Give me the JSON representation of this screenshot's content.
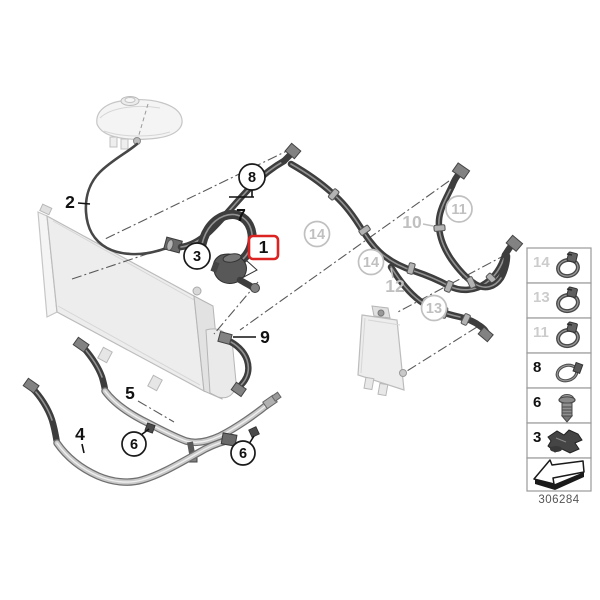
{
  "diagram_type": "cooling-system-hoses-parts-diagram",
  "colors": {
    "highlight_red": "#dd2222",
    "muted_gray": "#c0c0c0"
  },
  "callouts": {
    "1": {
      "label": "1",
      "highlighted": true
    },
    "2": {
      "label": "2"
    },
    "3": {
      "label": "3"
    },
    "4": {
      "label": "4"
    },
    "5": {
      "label": "5"
    },
    "6": {
      "label": "6"
    },
    "7": {
      "label": "7"
    },
    "8": {
      "label": "8"
    },
    "9": {
      "label": "9"
    },
    "10": {
      "label": "10"
    },
    "11": {
      "label": "11"
    },
    "12": {
      "label": "12"
    },
    "13": {
      "label": "13"
    },
    "14": {
      "label": "14"
    }
  },
  "sidebar": {
    "items": [
      {
        "ref": "14",
        "tone": "muted",
        "icon": "worm-drive-clamp-icon"
      },
      {
        "ref": "13",
        "tone": "muted",
        "icon": "worm-drive-clamp-icon"
      },
      {
        "ref": "11",
        "tone": "muted",
        "icon": "worm-drive-clamp-icon"
      },
      {
        "ref": "8",
        "tone": "black",
        "icon": "spring-band-clamp-icon"
      },
      {
        "ref": "6",
        "tone": "black",
        "icon": "expansion-rivet-icon"
      },
      {
        "ref": "3",
        "tone": "black",
        "icon": "retaining-clip-icon"
      }
    ],
    "footer_icon": "direction-arrow-icon",
    "part_number": "306284"
  }
}
